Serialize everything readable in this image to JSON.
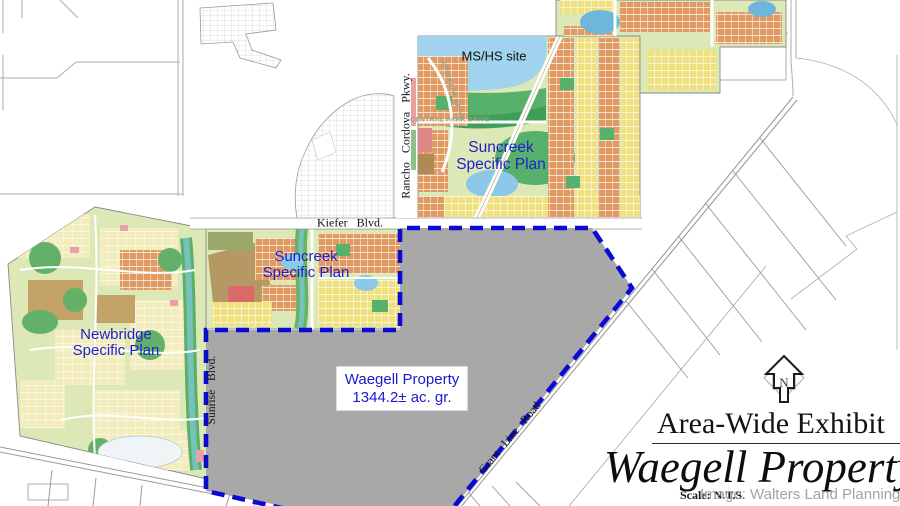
{
  "map": {
    "plan_labels": {
      "ms_hs_site": "MS/HS site",
      "suncreek_north": {
        "line1": "Suncreek",
        "line2": "Specific Plan"
      },
      "suncreek_south": {
        "line1": "Suncreek",
        "line2": "Specific Plan"
      },
      "newbridge": {
        "line1": "Newbridge",
        "line2": "Specific Plan"
      },
      "waegell": {
        "line1": "Waegell Property",
        "line2": "1344.2± ac. gr."
      }
    },
    "road_labels": {
      "kiefer": "Kiefer Blvd.",
      "rancho_cordova": "Rancho Cordova Pkwy.",
      "sunrise": "Sunrise Blvd.",
      "grant_line": "Grant Line Road",
      "central_park_drive": "CENTRAL PARK DRIVE",
      "westpark_drive": "WESTPARK DRIVE"
    },
    "north_arrow_letter": "N",
    "colors": {
      "plan_base_green": "#dce8b6",
      "park_green": "#57b06b",
      "lake_blue": "#9fd3ee",
      "pond_blue": "#7db9dc",
      "residential_orange": "#e09a62",
      "residential_yellow": "#f0e180",
      "pale_yellow": "#f3ecbc",
      "tan_brown": "#bf9e63",
      "red_block": "#d96a68",
      "creek_teal": "#74c2b8",
      "property_gray": "#a8a8a8",
      "boundary_blue": "#0a0ad0",
      "label_blue": "#2121cc"
    }
  },
  "title_block": {
    "title": "Area-Wide Exhibit",
    "subtitle": "Waegell Property",
    "scale_note": "Scale: N.T.S.",
    "credit": "Image: Walters Land Planning"
  }
}
